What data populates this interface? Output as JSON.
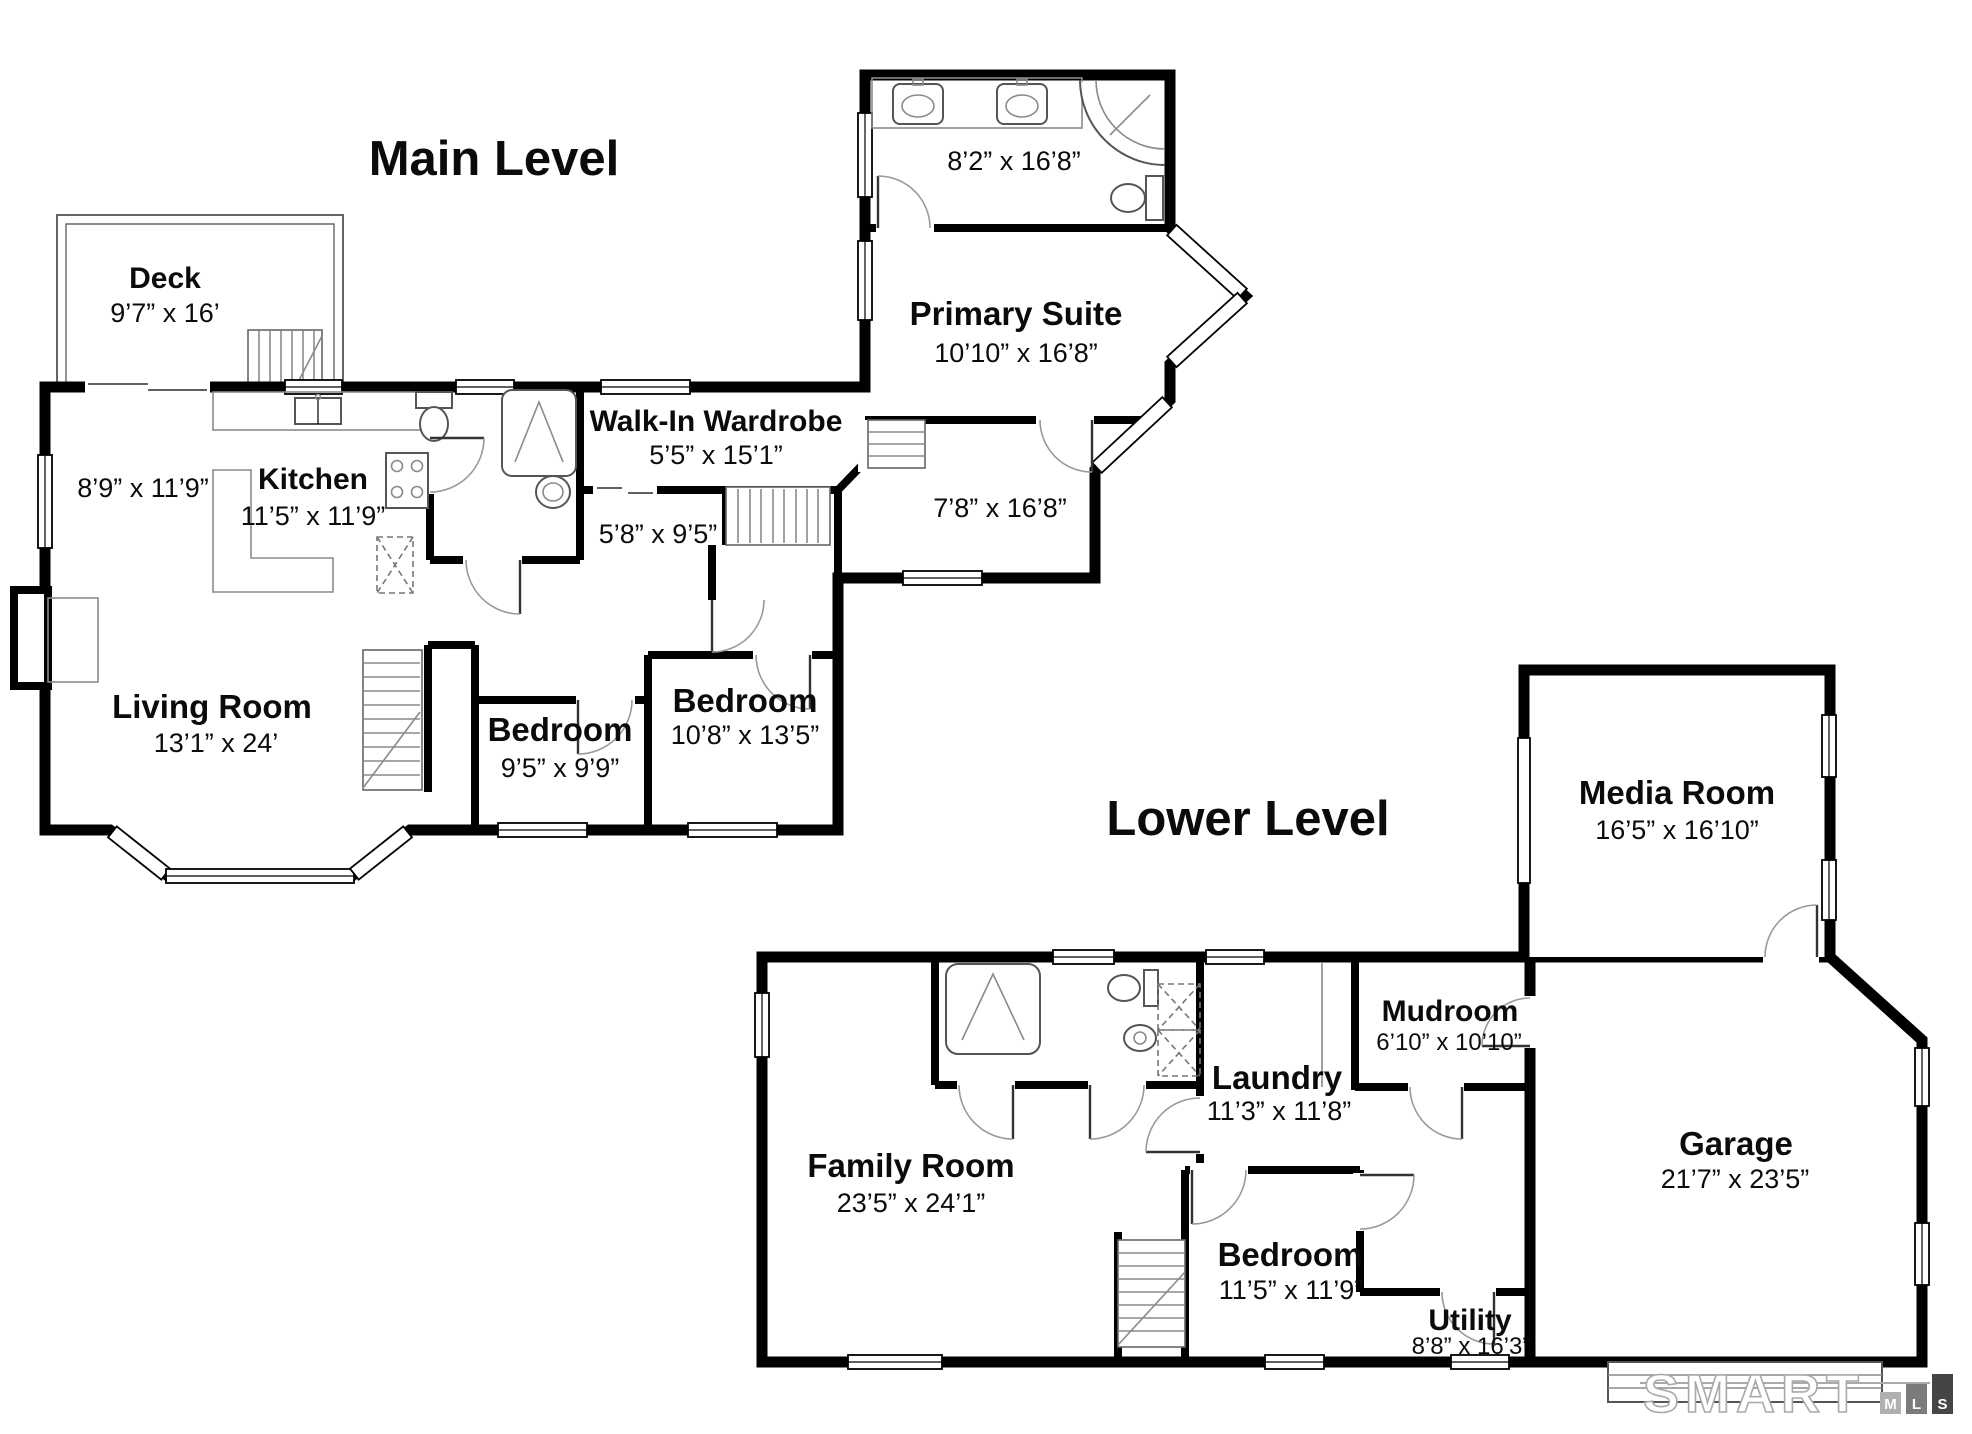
{
  "page": {
    "background": "#ffffff",
    "wall_color": "#000000"
  },
  "levels": {
    "main": {
      "title": "Main Level",
      "rooms": {
        "deck": {
          "name": "Deck",
          "dims": "9’7” x 16’"
        },
        "primary_bath": {
          "dims": "8’2” x 16’8”"
        },
        "primary_suite": {
          "name": "Primary Suite",
          "dims": "10’10” x 16’8”"
        },
        "front_room": {
          "dims": "7’8” x 16’8”"
        },
        "walk_in_wardrobe": {
          "name": "Walk-In Wardrobe",
          "dims": "5’5” x 15’1”"
        },
        "hall": {
          "dims": "5’8” x 9’5”"
        },
        "kitchen": {
          "name": "Kitchen",
          "dims": "11’5” x 11’9”"
        },
        "dining_nook": {
          "dims": "8’9” x 11’9”"
        },
        "living_room": {
          "name": "Living Room",
          "dims": "13’1” x 24’"
        },
        "bedroom_left": {
          "name": "Bedroom",
          "dims": "9’5” x 9’9”"
        },
        "bedroom_right": {
          "name": "Bedroom",
          "dims": "10’8” x 13’5”"
        }
      }
    },
    "lower": {
      "title": "Lower Level",
      "rooms": {
        "media_room": {
          "name": "Media Room",
          "dims": "16’5” x 16’10”"
        },
        "family_room": {
          "name": "Family Room",
          "dims": "23’5” x 24’1”"
        },
        "laundry": {
          "name": "Laundry",
          "dims": "11’3” x 11’8”"
        },
        "mudroom": {
          "name": "Mudroom",
          "dims": "6’10” x 10’10”"
        },
        "garage": {
          "name": "Garage",
          "dims": "21’7” x 23’5”"
        },
        "bedroom": {
          "name": "Bedroom",
          "dims": "11’5” x 11’9”"
        },
        "utility": {
          "name": "Utility",
          "dims": "8’8” x 16’3”"
        }
      }
    }
  },
  "branding": {
    "name": "SMART",
    "mls_letters": [
      "M",
      "L",
      "S"
    ],
    "box_colors": [
      "#b0b0b0",
      "#7b7b7b",
      "#454545"
    ],
    "line_color": "#a9a9a9"
  }
}
